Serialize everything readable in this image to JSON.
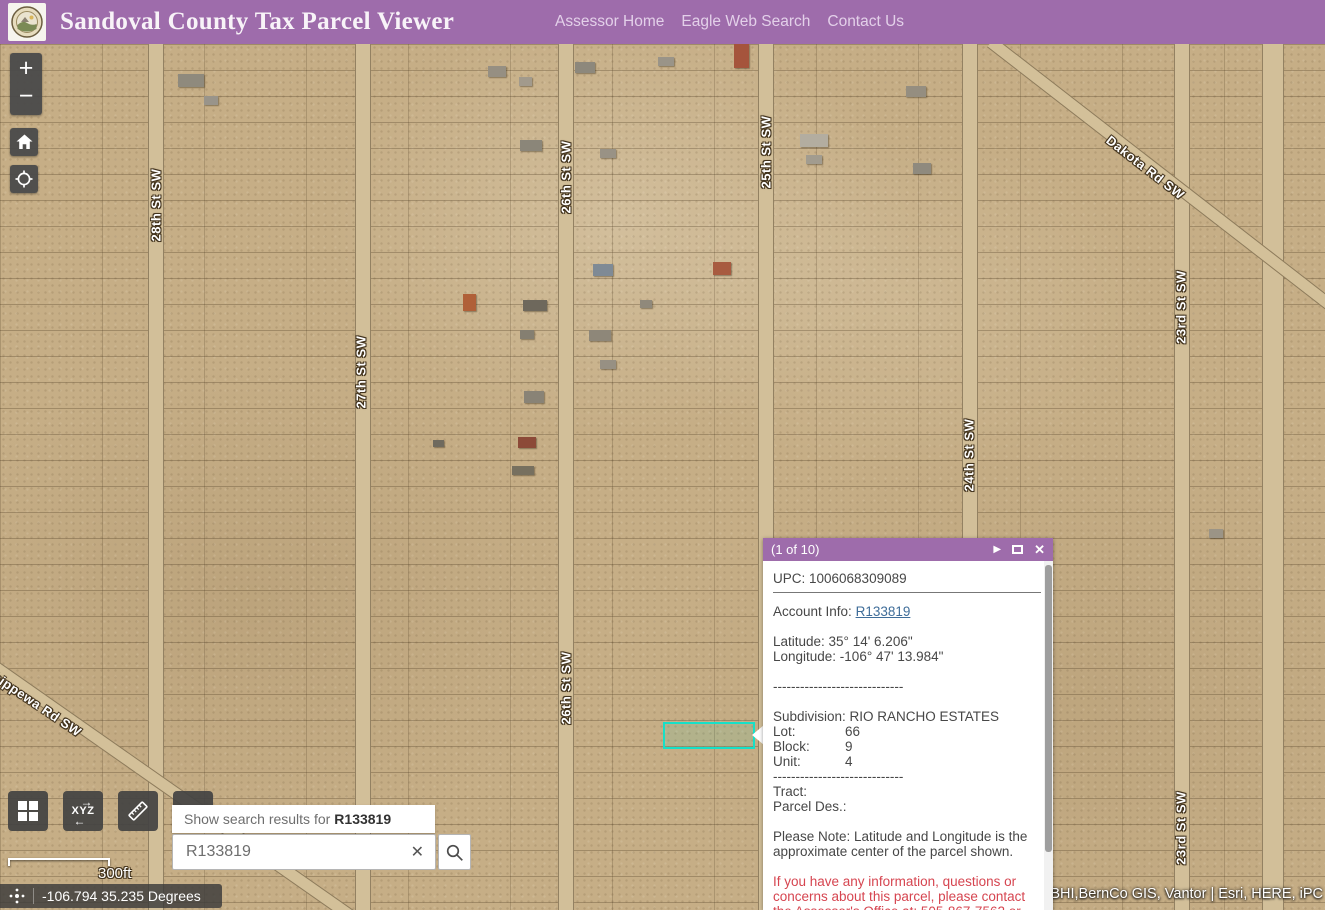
{
  "header": {
    "title": "Sandoval County Tax Parcel Viewer",
    "nav": [
      "Assessor Home",
      "Eagle Web Search",
      "Contact Us"
    ]
  },
  "map_controls": {
    "zoom_in_label": "+",
    "zoom_out_label": "−"
  },
  "icons": {
    "next_arrow": "▶",
    "close": "✕",
    "clear": "✕"
  },
  "map": {
    "street_labels": [
      {
        "text": "28th St SW"
      },
      {
        "text": "27th St SW"
      },
      {
        "text": "26th St SW"
      },
      {
        "text": "25th St SW"
      },
      {
        "text": "24th St SW"
      },
      {
        "text": "23rd St SW"
      },
      {
        "text": "26th St SW"
      },
      {
        "text": "23rd St SW"
      },
      {
        "text": "Dakota Rd SW"
      },
      {
        "text": "Chippewa Rd SW"
      }
    ],
    "highlight_color": "#16e0c8",
    "attribution": ",BHI,BernCo GIS, Vantor | Esri, HERE, iPC",
    "scale_label": "300ft",
    "coordinate_readout": "-106.794 35.235 Degrees"
  },
  "popup": {
    "pager": "(1 of 10)",
    "upc_line": "UPC: 1006068309089",
    "account_label": "Account Info:",
    "account_link": "R133819",
    "latitude_line": "Latitude: 35° 14' 6.206\"",
    "longitude_line": "Longitude: -106° 47' 13.984\"",
    "separator": "-----------------------------",
    "subdivision_line": "Subdivision: RIO RANCHO ESTATES",
    "fields": [
      {
        "label": "Lot:",
        "value": "66"
      },
      {
        "label": "Block:",
        "value": "9"
      },
      {
        "label": "Unit:",
        "value": "4"
      }
    ],
    "tract_line": "Tract:",
    "parcel_des_line": "Parcel Des.:",
    "note_line": "Please Note: Latitude and Longitude is the approximate center of the parcel shown.",
    "contact_warning": "If you have any information, questions or concerns about this parcel, please contact the Assessor's Office at: 505-867-7562 or"
  },
  "search": {
    "suggestion_prefix": "Show search results for",
    "suggestion_term": "R133819",
    "input_value": "R133819"
  },
  "toolbar": {
    "xyz_label": "XYZ"
  },
  "colors": {
    "header_purple": "#9e6cab",
    "link_blue": "#3f6d99",
    "warning_red": "#d64550",
    "highlight_teal": "#16e0c8"
  }
}
